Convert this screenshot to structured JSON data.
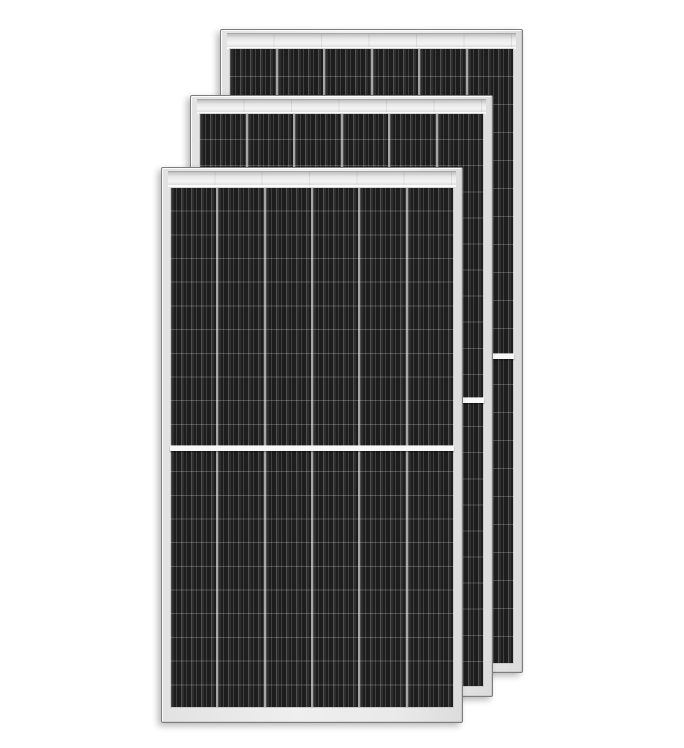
{
  "image": {
    "type": "product-render",
    "subject": "Three stacked monocrystalline half-cut solar panels on white background",
    "background_color": "#ffffff"
  },
  "colors": {
    "frame_face": "#e9e9e9",
    "frame_outline": "#7d7d7d",
    "rail_highlight": "#f5f5f5",
    "cell_dark": "#232323",
    "cell_finger_line": "rgba(255,255,255,0.16)",
    "column_gap": "#a6a6a6",
    "row_line": "rgba(255,255,255,0.22)",
    "center_divider": "#f8f8f8",
    "rail_column_tick": "rgba(0,0,0,0.08)"
  },
  "panels": [
    {
      "name": "solar-panel-back",
      "x": 220,
      "y": 29,
      "width": 303,
      "height": 644,
      "columns": 6,
      "rows": 22,
      "half_cut": true,
      "inset": {
        "top": 18,
        "right": 8,
        "bottom": 8,
        "left": 8
      },
      "rail_height": 13
    },
    {
      "name": "solar-panel-middle",
      "x": 190,
      "y": 95,
      "width": 303,
      "height": 602,
      "columns": 6,
      "rows": 22,
      "half_cut": true,
      "inset": {
        "top": 17,
        "right": 8,
        "bottom": 9,
        "left": 8
      },
      "rail_height": 12
    },
    {
      "name": "solar-panel-front",
      "x": 161,
      "y": 167,
      "width": 302,
      "height": 556,
      "columns": 6,
      "rows": 22,
      "half_cut": true,
      "inset": {
        "top": 19,
        "right": 8,
        "bottom": 14,
        "left": 8
      },
      "rail_height": 13
    }
  ]
}
